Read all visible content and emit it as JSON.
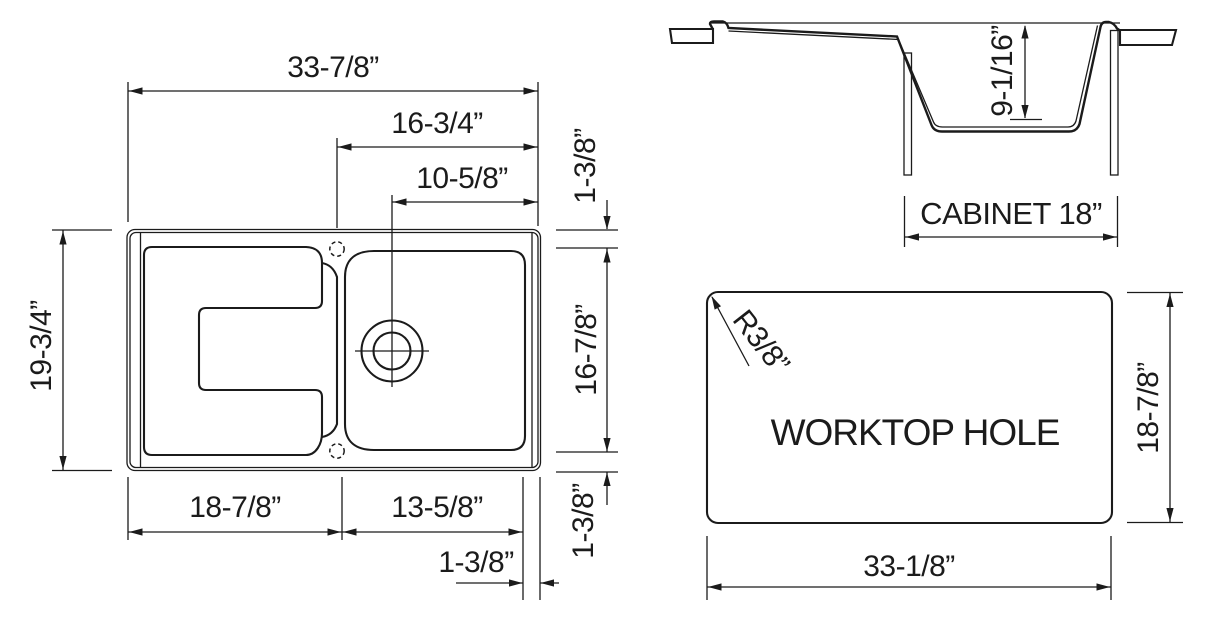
{
  "drawing_type": "sink-dimension-diagram",
  "colors": {
    "line": "#1b1b1b",
    "background": "#ffffff"
  },
  "plan": {
    "overall_width": "33-7/8”",
    "bowl_offset": "16-3/4”",
    "drain_offset": "10-5/8”",
    "overall_depth": "19-3/4”",
    "rim_top": "1-3/8”",
    "bowl_length": "16-7/8”",
    "rim_bottom": "1-3/8”",
    "drainboard_width": "18-7/8”",
    "bowl_width": "13-5/8”",
    "rim_right": "1-3/8”"
  },
  "section": {
    "bowl_depth": "9-1/16”",
    "cabinet_width": "CABINET 18”"
  },
  "cutout": {
    "label": "WORKTOP HOLE",
    "corner_radius": "R3/8”",
    "height": "18-7/8”",
    "width": "33-1/8”"
  }
}
